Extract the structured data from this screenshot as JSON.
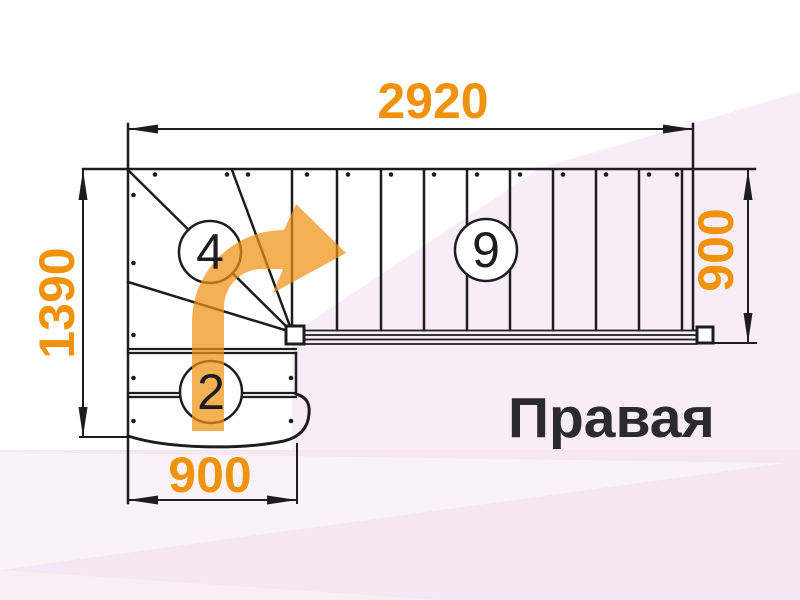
{
  "plan": {
    "orientation_label": "Правая",
    "dimensions": {
      "total_length_mm": "2920",
      "left_run_mm": "1390",
      "flight_width_mm": "900",
      "bottom_width_mm": "900"
    },
    "step_counts": {
      "winder": "4",
      "main_flight": "9",
      "bottom_flight": "2"
    },
    "colors": {
      "dimension_accent": "#EF930D",
      "arrow_orange": "#EE9212",
      "line": "#1D1D1F",
      "label_dark": "#2B2A2E",
      "background_pink": "#F7EBF4"
    },
    "icons": [
      {
        "name": "direction-arrow-icon",
        "meaning": "ascent direction curving up and to the right"
      }
    ]
  }
}
